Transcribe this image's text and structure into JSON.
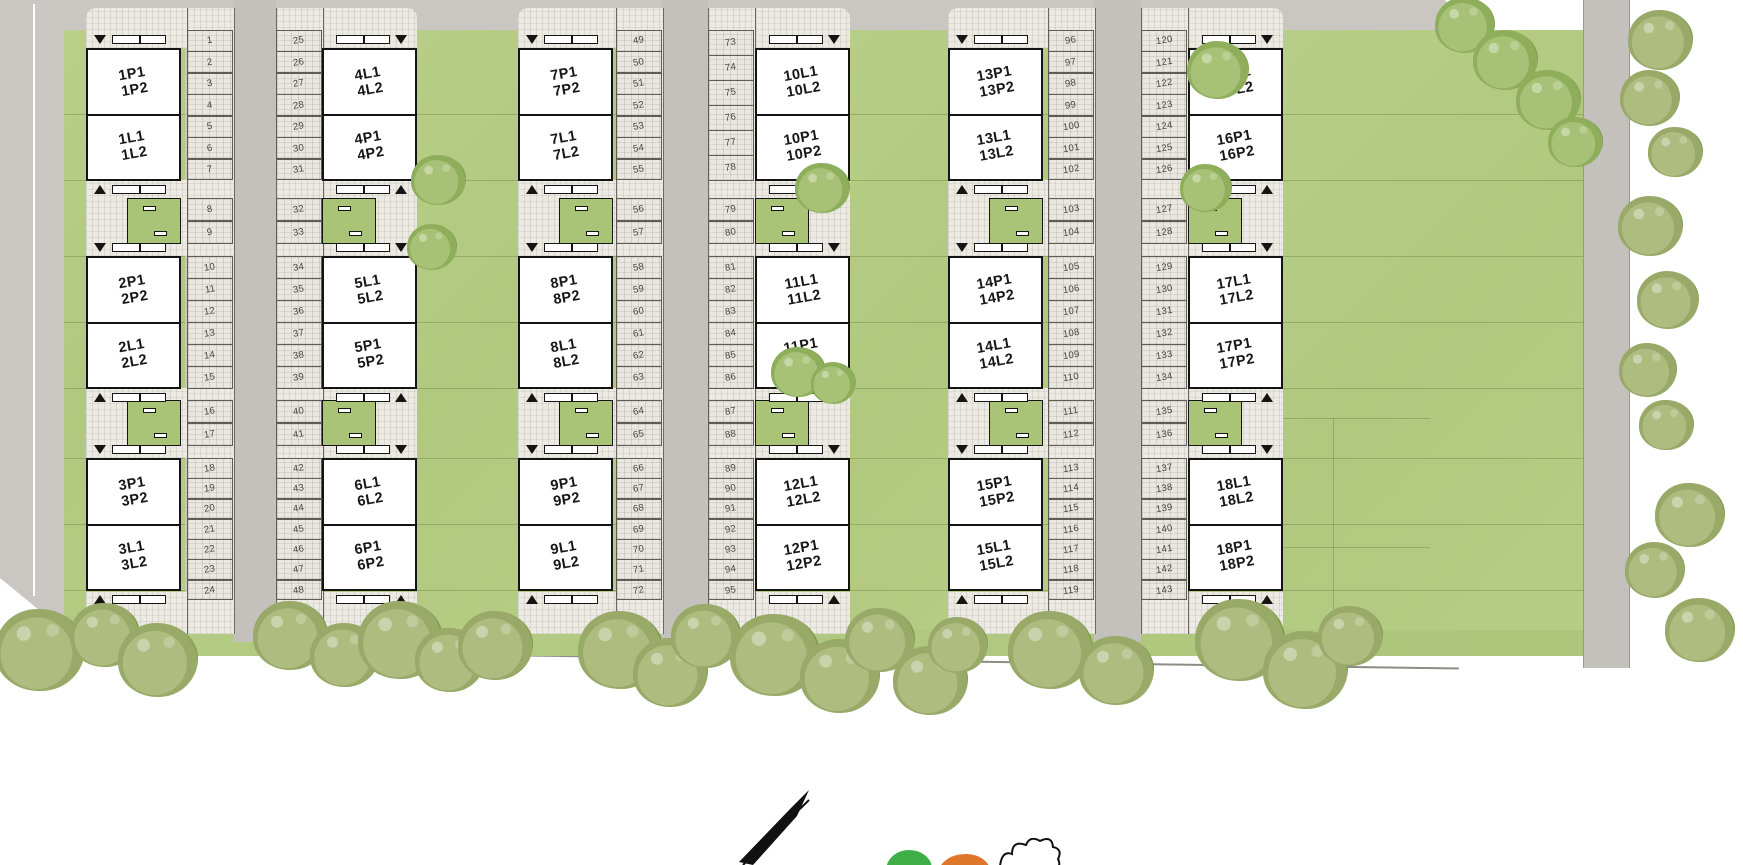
{
  "street": {
    "label": "UL. SŁONECZNA"
  },
  "columns": [
    {
      "id": 1,
      "parking_numbers": [
        [
          1,
          2,
          3,
          4,
          5,
          6,
          7
        ],
        [
          8,
          9
        ],
        [
          10,
          11,
          12,
          13,
          14,
          15
        ],
        [
          16,
          17
        ],
        [
          18,
          19,
          20,
          21,
          22,
          23,
          24
        ]
      ],
      "buildings": [
        {
          "upper": [
            "1P1",
            "1P2"
          ],
          "lower": [
            "1L1",
            "1L2"
          ]
        },
        {
          "upper": [
            "2P1",
            "2P2"
          ],
          "lower": [
            "2L1",
            "2L2"
          ]
        },
        {
          "upper": [
            "3P1",
            "3P2"
          ],
          "lower": [
            "3L1",
            "3L2"
          ]
        }
      ]
    },
    {
      "id": 2,
      "parking_numbers": [
        [
          25,
          26,
          27,
          28,
          29,
          30,
          31
        ],
        [
          32,
          33
        ],
        [
          34,
          35,
          36,
          37,
          38,
          39
        ],
        [
          40,
          41
        ],
        [
          42,
          43,
          44,
          45,
          46,
          47,
          48
        ]
      ],
      "buildings": [
        {
          "upper": [
            "4L1",
            "4L2"
          ],
          "lower": [
            "4P1",
            "4P2"
          ]
        },
        {
          "upper": [
            "5L1",
            "5L2"
          ],
          "lower": [
            "5P1",
            "5P2"
          ]
        },
        {
          "upper": [
            "6L1",
            "6L2"
          ],
          "lower": [
            "6P1",
            "6P2"
          ]
        }
      ]
    },
    {
      "id": 3,
      "parking_numbers": [
        [
          49,
          50,
          51,
          52,
          53,
          54,
          55
        ],
        [
          56,
          57
        ],
        [
          58,
          59,
          60,
          61,
          62,
          63
        ],
        [
          64,
          65
        ],
        [
          66,
          67,
          68,
          69,
          70,
          71,
          72
        ]
      ],
      "buildings": [
        {
          "upper": [
            "7P1",
            "7P2"
          ],
          "lower": [
            "7L1",
            "7L2"
          ]
        },
        {
          "upper": [
            "8P1",
            "8P2"
          ],
          "lower": [
            "8L1",
            "8L2"
          ]
        },
        {
          "upper": [
            "9P1",
            "9P2"
          ],
          "lower": [
            "9L1",
            "9L2"
          ]
        }
      ]
    },
    {
      "id": 4,
      "parking_numbers": [
        [
          73,
          74,
          75,
          76,
          77,
          78
        ],
        [
          79,
          80
        ],
        [
          81,
          82,
          83,
          84,
          85,
          86
        ],
        [
          87,
          88
        ],
        [
          89,
          90,
          91,
          92,
          93,
          94,
          95
        ]
      ],
      "buildings": [
        {
          "upper": [
            "10L1",
            "10L2"
          ],
          "lower": [
            "10P1",
            "10P2"
          ]
        },
        {
          "upper": [
            "11L1",
            "11L2"
          ],
          "lower": [
            "11P1",
            "11P2"
          ]
        },
        {
          "upper": [
            "12L1",
            "12L2"
          ],
          "lower": [
            "12P1",
            "12P2"
          ]
        }
      ]
    },
    {
      "id": 5,
      "parking_numbers": [
        [
          96,
          97,
          98,
          99,
          100,
          101,
          102
        ],
        [
          103,
          104
        ],
        [
          105,
          106,
          107,
          108,
          109,
          110
        ],
        [
          111,
          112
        ],
        [
          113,
          114,
          115,
          116,
          117,
          118,
          119
        ]
      ],
      "buildings": [
        {
          "upper": [
            "13P1",
            "13P2"
          ],
          "lower": [
            "13L1",
            "13L2"
          ]
        },
        {
          "upper": [
            "14P1",
            "14P2"
          ],
          "lower": [
            "14L1",
            "14L2"
          ]
        },
        {
          "upper": [
            "15P1",
            "15P2"
          ],
          "lower": [
            "15L1",
            "15L2"
          ]
        }
      ]
    },
    {
      "id": 6,
      "parking_numbers": [
        [
          120,
          121,
          122,
          123,
          124,
          125,
          126
        ],
        [
          127,
          128
        ],
        [
          129,
          130,
          131,
          132,
          133,
          134
        ],
        [
          135,
          136
        ],
        [
          137,
          138,
          139,
          140,
          141,
          142,
          143
        ]
      ],
      "buildings": [
        {
          "upper": [
            "16L1",
            "16L2"
          ],
          "lower": [
            "16P1",
            "16P2"
          ]
        },
        {
          "upper": [
            "17L1",
            "17L2"
          ],
          "lower": [
            "17P1",
            "17P2"
          ]
        },
        {
          "upper": [
            "18L1",
            "18L2"
          ],
          "lower": [
            "18P1",
            "18P2"
          ]
        }
      ]
    }
  ],
  "legend": {
    "icons": [
      "north-arrow-icon",
      "legend-tree-green-icon",
      "legend-tree-orange-icon",
      "tree-sketch-icon"
    ]
  },
  "colors": {
    "road": "#c4c1bc",
    "outer_gray": "#cac7c2",
    "lawn": "#b6cd86",
    "courtyard": "#a9c377",
    "paving": "#eae7e0",
    "building_fill": "#ffffff",
    "line": "#141414",
    "legend_green": "#3fae47",
    "legend_orange": "#e0762a"
  }
}
